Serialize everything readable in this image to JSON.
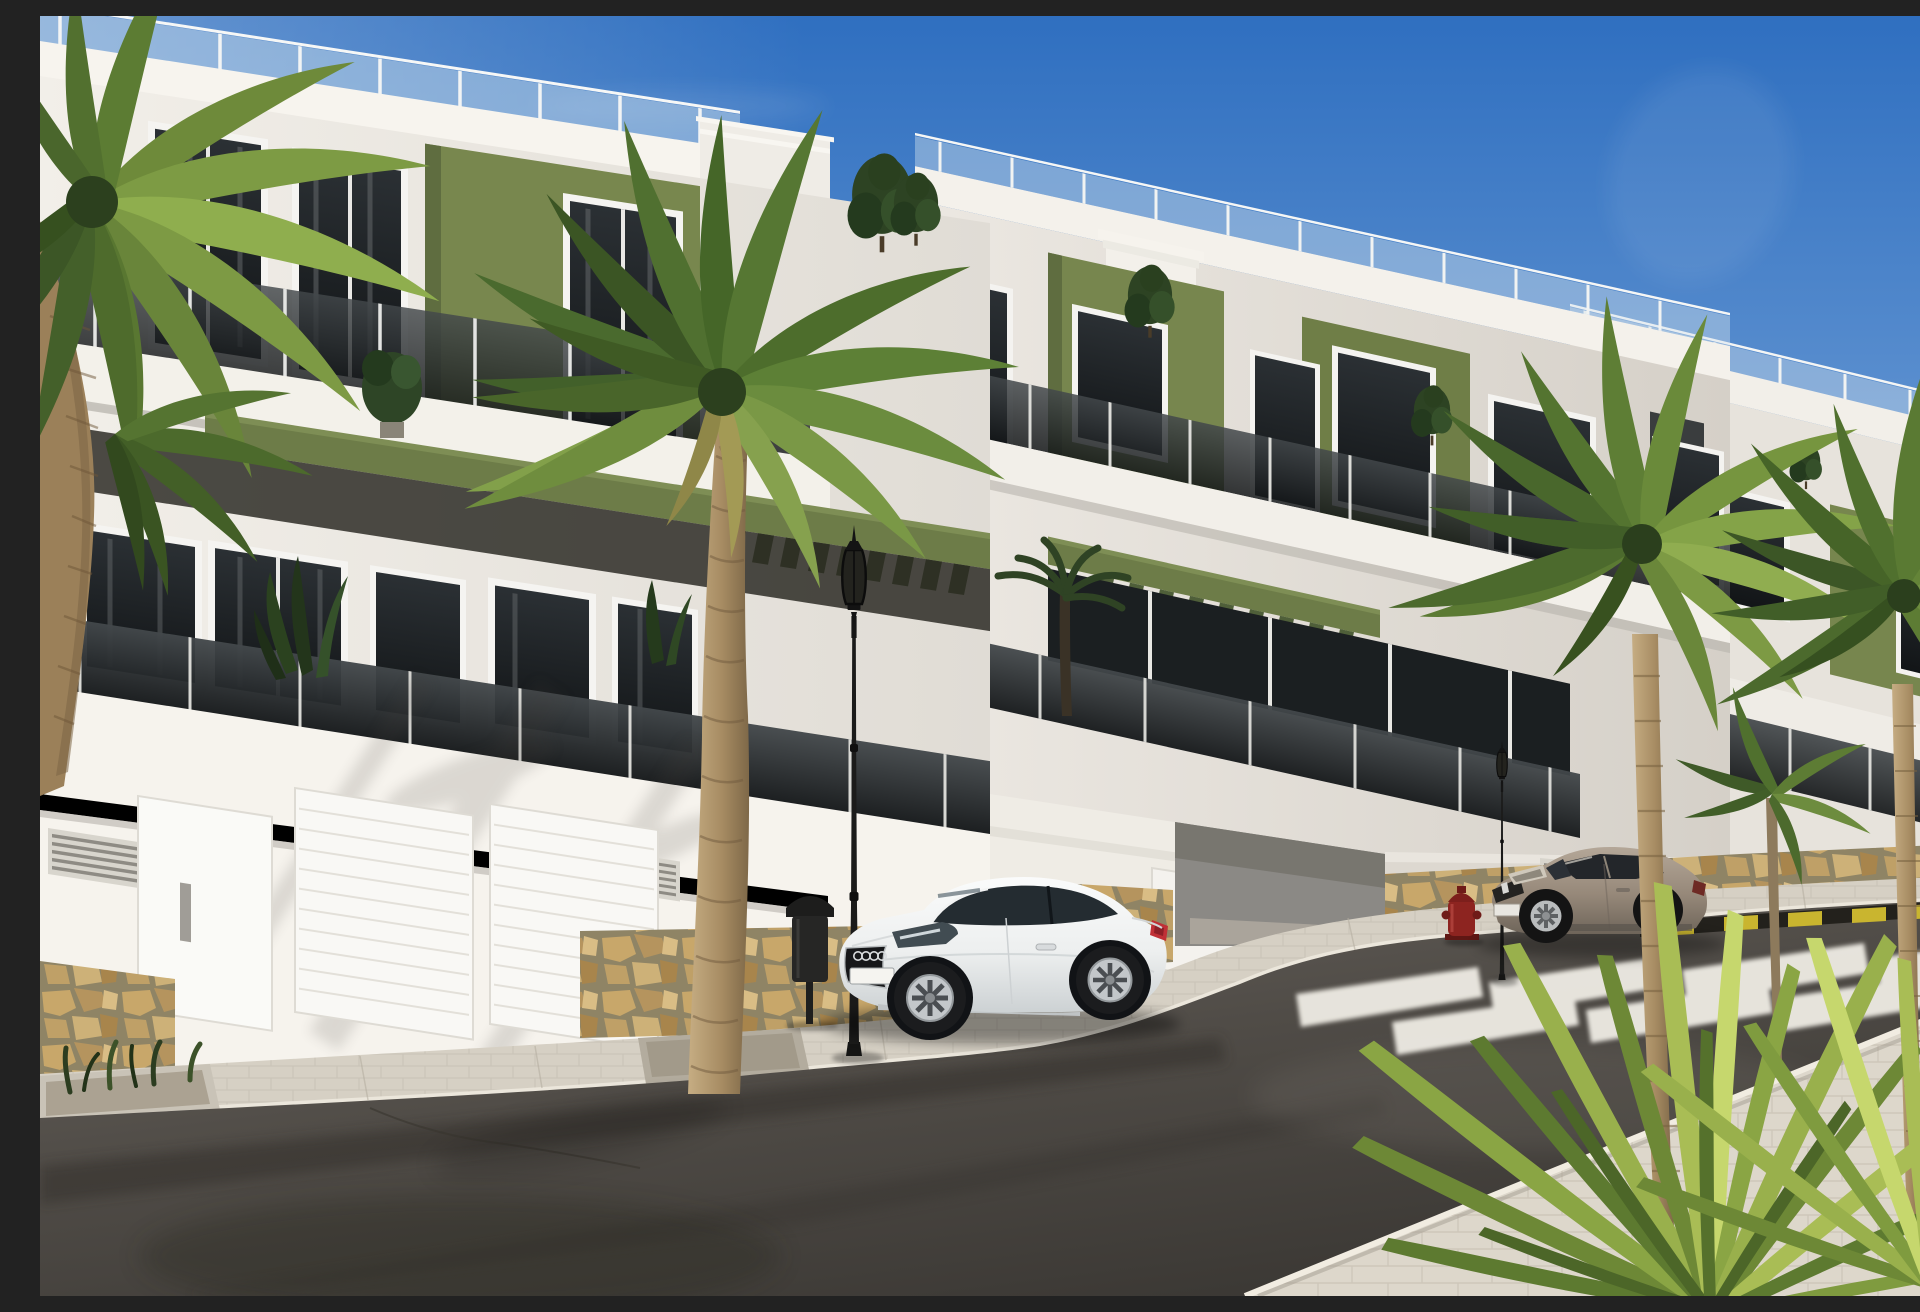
{
  "scene": {
    "title": "Sunny street view of a new-build modern apartment complex with palm trees and two parked cars",
    "sky": {
      "top_color": "#2f6fc0",
      "mid_color": "#7fa6d6",
      "horizon_color": "#dfe9f3",
      "clouds": "faint thin wisps"
    },
    "buildings": {
      "style": "white render apartment blocks, three floors, stepped perspective to the right",
      "accent_color": "#77864e",
      "accent_color_dark": "#55633a",
      "wall_white": "#f1eee8",
      "wall_shade": "#d8d4cd",
      "glazing_dark": "#1c2022",
      "frame_white": "#f6f5f2",
      "features": [
        "roof terraces with glass railings",
        "tinted glass balcony balustrades",
        "olive green accent panels",
        "green pergola louvers",
        "rooftop shrubs",
        "stone-clad base",
        "white sectional garage doors",
        "ventilation grilles"
      ]
    },
    "street": {
      "road_color": "#55514c",
      "sidewalk_color": "#d5cfc3",
      "stone_color": "#c2a06a",
      "crosswalk": {
        "stripe_color": "#efece4",
        "stripes_visible": 7
      },
      "curb_marking": {
        "colors": [
          "#c9b52f",
          "#23211c"
        ],
        "pattern": "yellow-black diagonal band"
      },
      "furniture": [
        "ornate black street lamp near palm",
        "ornate black street lamp mid-right",
        "ornate black street lamp far right",
        "black litter bin",
        "red fire hydrant"
      ]
    },
    "vehicles": [
      {
        "name": "white sports coupe",
        "body_color": "#f2f3f3",
        "position": "parked at curb, centre",
        "details": [
          "dark grille",
          "white licence plate",
          "alloy wheels",
          "red tail light"
        ]
      },
      {
        "name": "bronze-grey coupe",
        "body_color": "#96887d",
        "position": "parked near crosswalk, right",
        "details": [
          "dark windows",
          "alloy wheels"
        ]
      }
    ],
    "vegetation": {
      "palms": [
        "large palm over top-left corner",
        "tall central palm in sidewalk pit",
        "two palms on near sidewalk right",
        "slim young palm far right"
      ],
      "other": [
        "spiky yucca shrub bottom-right",
        "balcony ball tree",
        "terrace banana plants",
        "rooftop cypress shrubs",
        "planter tufts bottom-left"
      ],
      "frond_greens": [
        "#3b5524",
        "#567733",
        "#7a9846",
        "#a9bd55"
      ],
      "trunk_color": "#ab9169"
    },
    "lighting": "strong sunlight from upper left, soft palm shadows on white walls"
  }
}
